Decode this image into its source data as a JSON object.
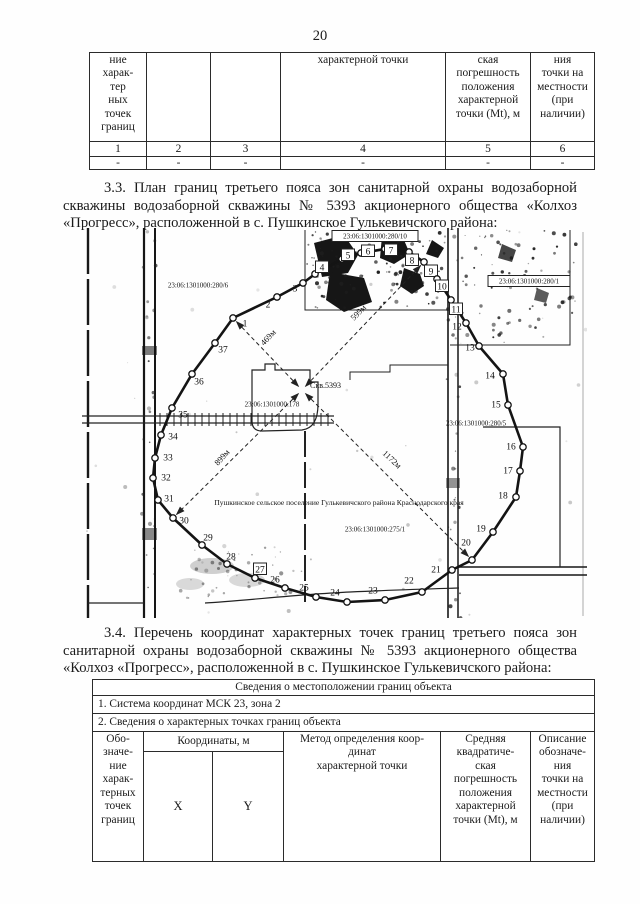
{
  "page_number": "20",
  "top_table": {
    "headers": [
      "ние\nхарак-\nтер\nных\nточек\nграниц",
      "",
      "",
      "характерной точки",
      "ская\nпогрешность\nположения\nхарактерной\nточки (Mt), м",
      "ния\nточки на\nместности\n(при\nналичии)"
    ],
    "numbers": [
      "1",
      "2",
      "3",
      "4",
      "5",
      "6"
    ],
    "dashes": [
      "-",
      "-",
      "-",
      "-",
      "-",
      "-"
    ]
  },
  "para_3_3": "3.3. План границ третьего пояса зон санитарной охраны водозаборной скважины водозаборной скважины № 5393 акционерного общества «Колхоз «Прогресс», расположенной в с. Пушкинское Гулькевичского района:",
  "para_3_4": "3.4. Перечень координат характерных точек границ третьего пояса зон санитарной охраны водозаборной скважины № 5393 акционерного общества «Колхоз «Прогресс», расположенной в с. Пушкинское Гулькевичского района:",
  "map": {
    "well": {
      "label": "Скв.5393",
      "x": 220,
      "y": 162,
      "label_x": 228,
      "label_y": 160
    },
    "settlement": {
      "text": "Пушкинское сельское поселение Гулькевичского района Краснодарского края",
      "x": 257,
      "y": 277
    },
    "cadastral": [
      {
        "text": "23:06:1301000:280/6",
        "x": 116,
        "y": 57,
        "boxed": false
      },
      {
        "text": "23:06:1301000:280/10",
        "x": 293,
        "y": 8,
        "boxed": true
      },
      {
        "text": "23:06:1301000:280/1",
        "x": 447,
        "y": 53,
        "boxed": true
      },
      {
        "text": "23:06:1301000:178",
        "x": 190,
        "y": 176,
        "boxed": false
      },
      {
        "text": "23:06:1301000:280/5",
        "x": 394,
        "y": 195,
        "boxed": false
      },
      {
        "text": "23:06:1301000:275/1",
        "x": 293,
        "y": 301,
        "boxed": false
      }
    ],
    "distances": [
      {
        "text": "469м",
        "x": 182,
        "y": 118,
        "rot": -47
      },
      {
        "text": "599м",
        "x": 272,
        "y": 93,
        "rot": -46
      },
      {
        "text": "899м",
        "x": 136,
        "y": 238,
        "rot": -48
      },
      {
        "text": "1172м",
        "x": 300,
        "y": 226,
        "rot": 43
      }
    ],
    "radials": [
      1,
      9,
      30,
      20
    ],
    "points": [
      {
        "n": "1",
        "x": 151,
        "y": 90,
        "lx": 163,
        "ly": 95,
        "boxed": false
      },
      {
        "n": "2",
        "x": 195,
        "y": 69,
        "lx": 186,
        "ly": 76,
        "boxed": false
      },
      {
        "n": "3",
        "x": 221,
        "y": 55,
        "lx": 213,
        "ly": 60,
        "boxed": false
      },
      {
        "n": "4",
        "x": 233,
        "y": 46,
        "lx": 240,
        "ly": 39,
        "boxed": true
      },
      {
        "n": "5",
        "x": 260,
        "y": 31,
        "lx": 266,
        "ly": 27,
        "boxed": true
      },
      {
        "n": "6",
        "x": 279,
        "y": 25,
        "lx": 286,
        "ly": 23,
        "boxed": true
      },
      {
        "n": "7",
        "x": 303,
        "y": 21,
        "lx": 309,
        "ly": 22,
        "boxed": true
      },
      {
        "n": "8",
        "x": 327,
        "y": 24,
        "lx": 330,
        "ly": 32,
        "boxed": true
      },
      {
        "n": "9",
        "x": 342,
        "y": 34,
        "lx": 349,
        "ly": 43,
        "boxed": true
      },
      {
        "n": "10",
        "x": 355,
        "y": 51,
        "lx": 360,
        "ly": 58,
        "boxed": true
      },
      {
        "n": "11",
        "x": 369,
        "y": 72,
        "lx": 374,
        "ly": 81,
        "boxed": true
      },
      {
        "n": "12",
        "x": 384,
        "y": 95,
        "lx": 375,
        "ly": 98,
        "boxed": false
      },
      {
        "n": "13",
        "x": 397,
        "y": 118,
        "lx": 388,
        "ly": 119,
        "boxed": false
      },
      {
        "n": "14",
        "x": 421,
        "y": 146,
        "lx": 408,
        "ly": 147,
        "boxed": false
      },
      {
        "n": "15",
        "x": 426,
        "y": 177,
        "lx": 414,
        "ly": 176,
        "boxed": false
      },
      {
        "n": "16",
        "x": 441,
        "y": 219,
        "lx": 429,
        "ly": 218,
        "boxed": false
      },
      {
        "n": "17",
        "x": 438,
        "y": 243,
        "lx": 426,
        "ly": 242,
        "boxed": false
      },
      {
        "n": "18",
        "x": 434,
        "y": 269,
        "lx": 421,
        "ly": 267,
        "boxed": false
      },
      {
        "n": "19",
        "x": 411,
        "y": 304,
        "lx": 399,
        "ly": 300,
        "boxed": false
      },
      {
        "n": "20",
        "x": 390,
        "y": 332,
        "lx": 384,
        "ly": 314,
        "boxed": false
      },
      {
        "n": "21",
        "x": 370,
        "y": 342,
        "lx": 354,
        "ly": 341,
        "boxed": false
      },
      {
        "n": "22",
        "x": 340,
        "y": 364,
        "lx": 327,
        "ly": 352,
        "boxed": false
      },
      {
        "n": "23",
        "x": 303,
        "y": 372,
        "lx": 291,
        "ly": 362,
        "boxed": false
      },
      {
        "n": "24",
        "x": 265,
        "y": 374,
        "lx": 253,
        "ly": 364,
        "boxed": false
      },
      {
        "n": "25",
        "x": 234,
        "y": 369,
        "lx": 222,
        "ly": 359,
        "boxed": false
      },
      {
        "n": "26",
        "x": 203,
        "y": 360,
        "lx": 193,
        "ly": 351,
        "boxed": false
      },
      {
        "n": "27",
        "x": 173,
        "y": 350,
        "lx": 178,
        "ly": 341,
        "boxed": true
      },
      {
        "n": "28",
        "x": 145,
        "y": 336,
        "lx": 149,
        "ly": 328,
        "boxed": false
      },
      {
        "n": "29",
        "x": 120,
        "y": 317,
        "lx": 126,
        "ly": 309,
        "boxed": false
      },
      {
        "n": "30",
        "x": 91,
        "y": 290,
        "lx": 102,
        "ly": 292,
        "boxed": false
      },
      {
        "n": "31",
        "x": 76,
        "y": 272,
        "lx": 87,
        "ly": 270,
        "boxed": false
      },
      {
        "n": "32",
        "x": 71,
        "y": 250,
        "lx": 84,
        "ly": 249,
        "boxed": false
      },
      {
        "n": "33",
        "x": 73,
        "y": 230,
        "lx": 86,
        "ly": 229,
        "boxed": false
      },
      {
        "n": "34",
        "x": 79,
        "y": 207,
        "lx": 91,
        "ly": 208,
        "boxed": false
      },
      {
        "n": "35",
        "x": 90,
        "y": 180,
        "lx": 101,
        "ly": 186,
        "boxed": false
      },
      {
        "n": "36",
        "x": 110,
        "y": 146,
        "lx": 117,
        "ly": 153,
        "boxed": false
      },
      {
        "n": "37",
        "x": 133,
        "y": 115,
        "lx": 141,
        "ly": 121,
        "boxed": false
      }
    ]
  },
  "bottom_table": {
    "title": "Сведения о местоположении границ объекта",
    "row1": "1. Система координат МСК 23, зона 2",
    "row2": "2. Сведения о характерных точках границ объекта",
    "col_designation": "Обо-\nзначе-\nние\nхарак-\nтерных\nточек\nграниц",
    "coords_header": "Координаты, м",
    "x_label": "X",
    "y_label": "Y",
    "col_method": "Метод определения коор-\nдинат\nхарактерной точки",
    "col_error": "Средняя\nквадратиче-\nская\nпогрешность\nположения\nхарактерной\nточки (Mt), м",
    "col_description": "Описание\nобозначе-\nния\nточки на\nместности\n(при\nналичии)"
  }
}
